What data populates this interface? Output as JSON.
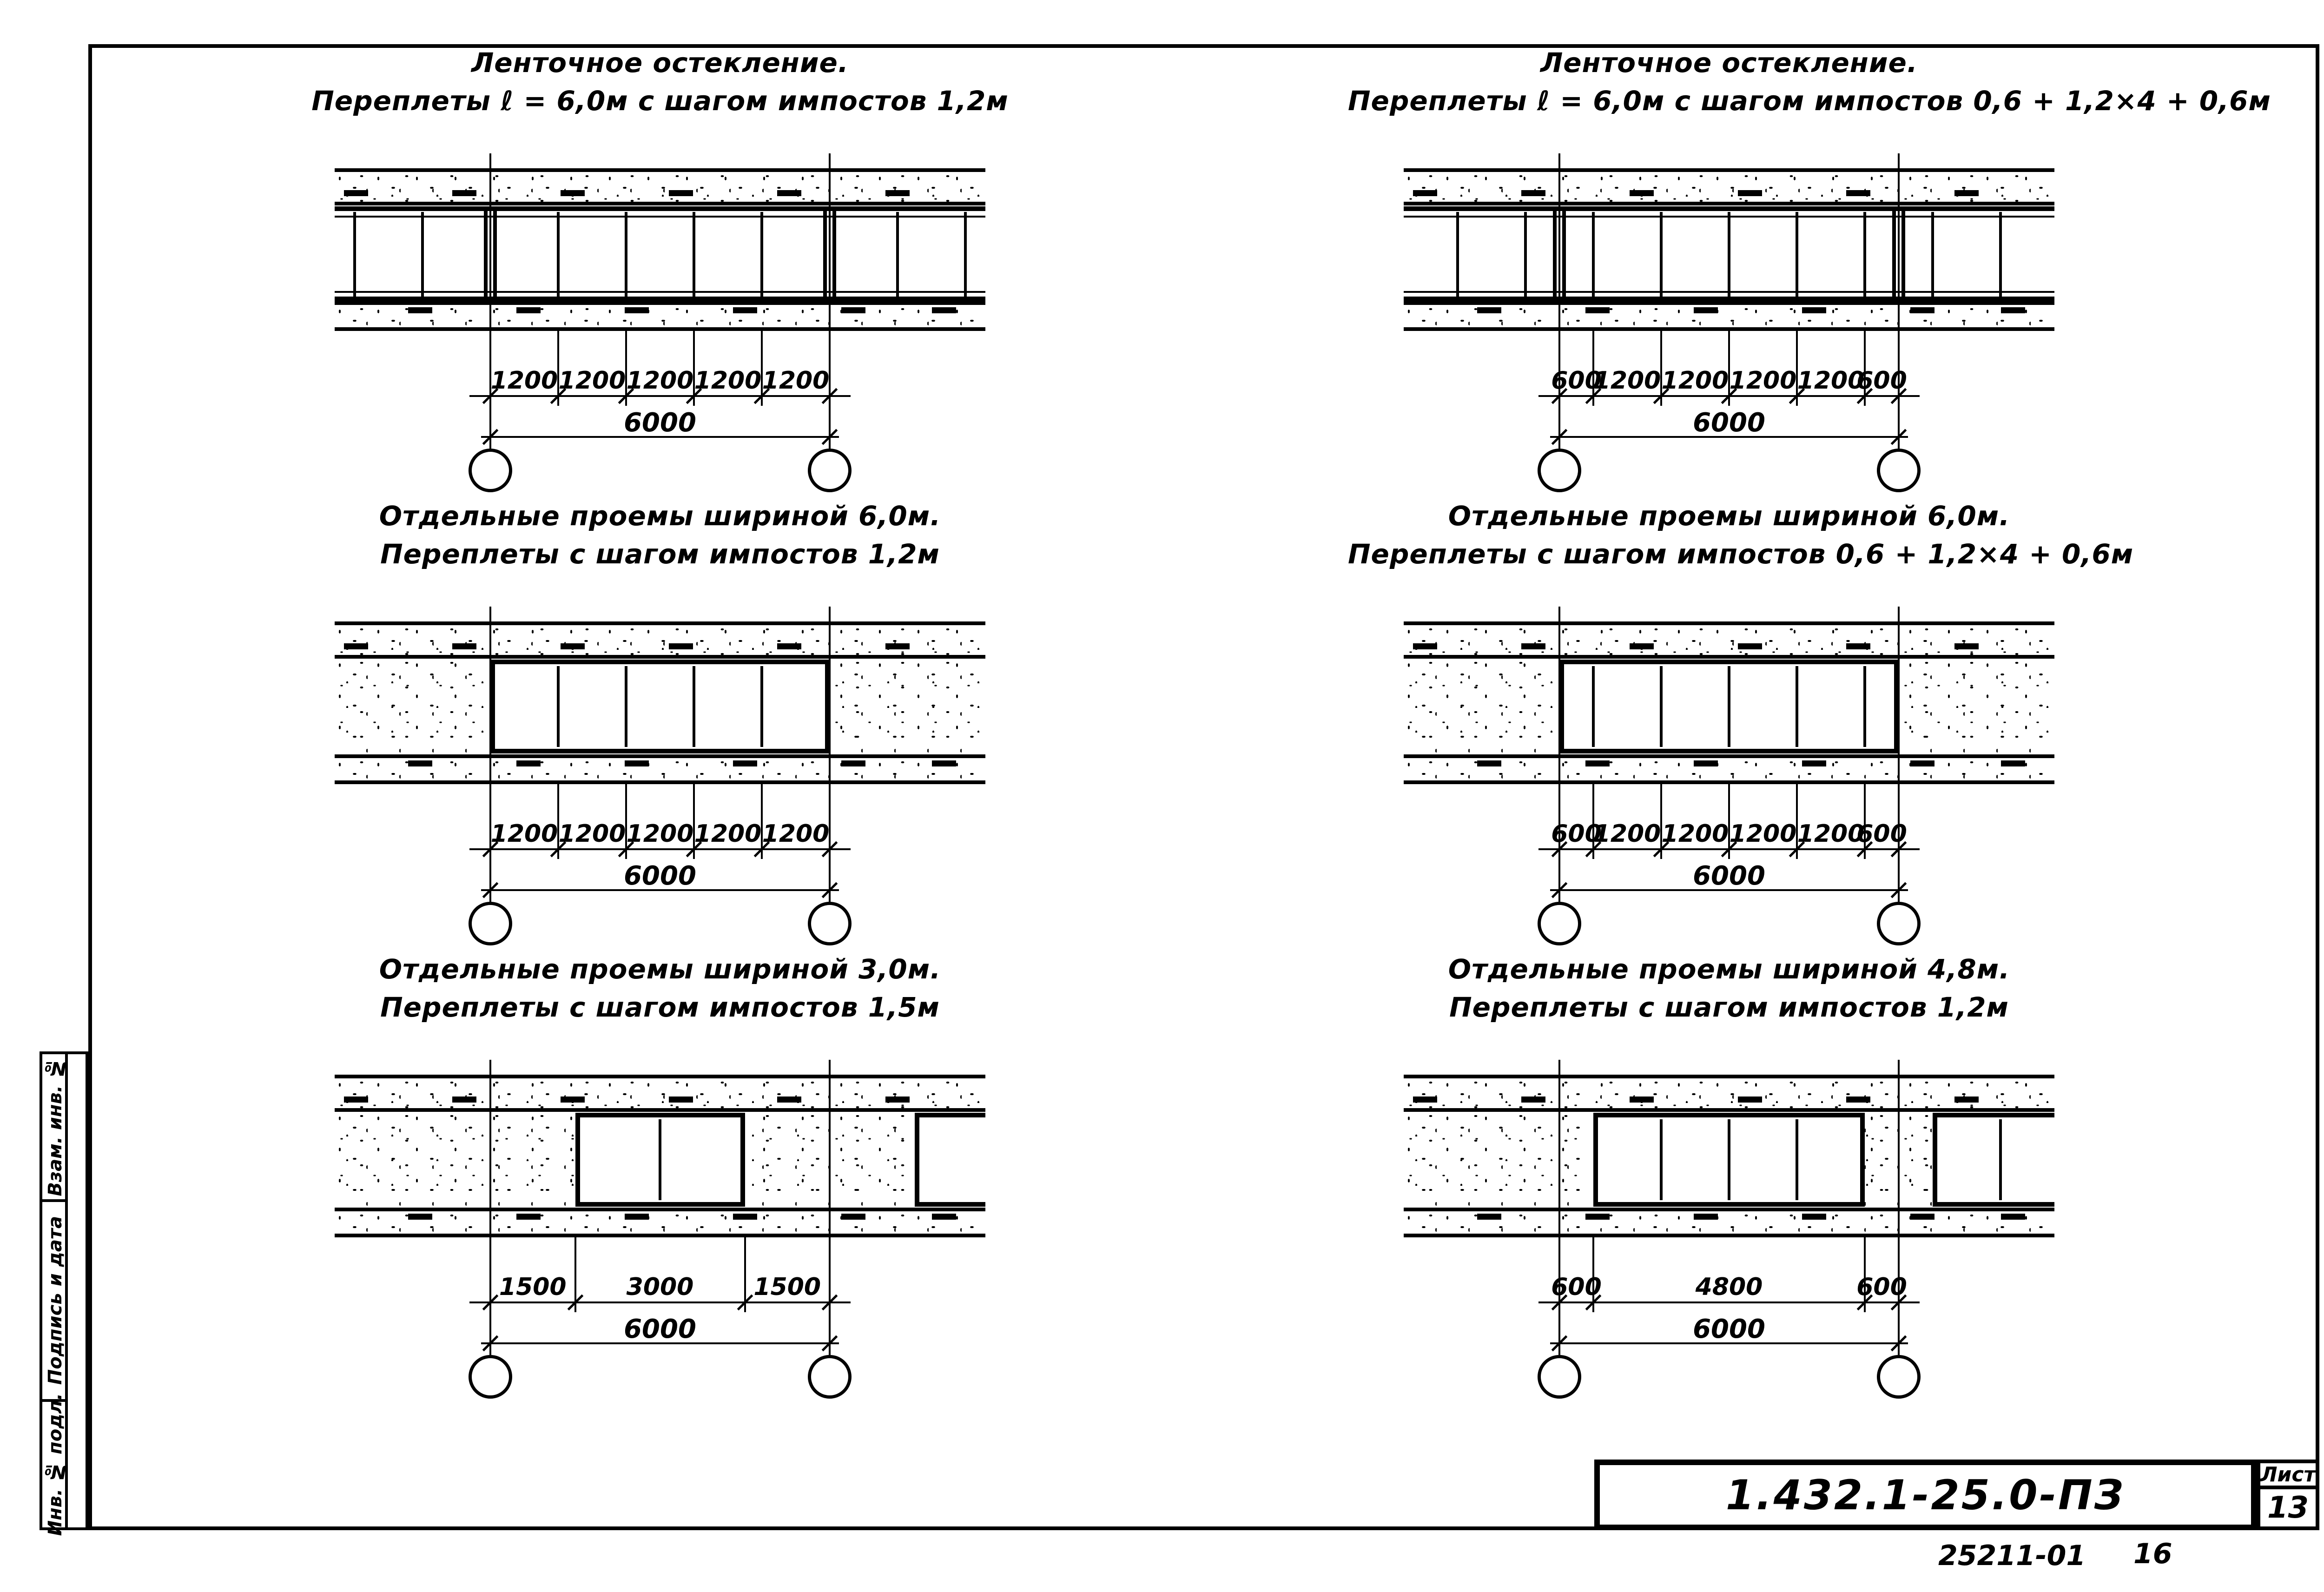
{
  "sheet": {
    "title_block": {
      "code": "1.432.1-25.0-ПЗ",
      "sheet_label": "Лист",
      "sheet_number": "13"
    },
    "margin_notes": [
      "25211-01",
      "16"
    ],
    "side_stamp_labels": [
      "Взам. инв. №",
      "Подпись и дата",
      "Инв. № подл."
    ]
  },
  "panels": [
    {
      "id": "ribbon-1200",
      "title1": "Ленточное остекление.",
      "title2": "Переплеты ℓ = 6,0м с шагом импостов 1,2м",
      "type": "ribbon",
      "segments": [
        1200,
        1200,
        1200,
        1200,
        1200
      ],
      "segment_labels": [
        "1200",
        "1200",
        "1200",
        "1200",
        "1200"
      ],
      "total_label": "6000",
      "side_mullions": [
        1200,
        2400
      ]
    },
    {
      "id": "ribbon-600-1200",
      "title1": "Ленточное остекление.",
      "title2": "Переплеты ℓ = 6,0м с шагом импостов 0,6 + 1,2×4 + 0,6м",
      "type": "ribbon",
      "segments": [
        600,
        1200,
        1200,
        1200,
        1200,
        600
      ],
      "segment_labels": [
        "600",
        "1200",
        "1200",
        "1200",
        "1200",
        "600"
      ],
      "total_label": "6000",
      "side_mullions": [
        600,
        1800
      ]
    },
    {
      "id": "opening-6000-1200",
      "title1": "Отдельные проемы шириной 6,0м.",
      "title2": "Переплеты с шагом импостов 1,2м",
      "type": "opening",
      "segments": [
        1200,
        1200,
        1200,
        1200,
        1200
      ],
      "segment_labels": [
        "1200",
        "1200",
        "1200",
        "1200",
        "1200"
      ],
      "total_label": "6000",
      "opening": [
        0,
        6000
      ],
      "opening_mullions": [
        1200,
        2400,
        3600,
        4800
      ]
    },
    {
      "id": "opening-6000-600-1200",
      "title1": "Отдельные проемы шириной 6,0м.",
      "title2": "Переплеты с шагом импостов 0,6 + 1,2×4 + 0,6м",
      "type": "opening",
      "segments": [
        600,
        1200,
        1200,
        1200,
        1200,
        600
      ],
      "segment_labels": [
        "600",
        "1200",
        "1200",
        "1200",
        "1200",
        "600"
      ],
      "total_label": "6000",
      "opening": [
        0,
        6000
      ],
      "opening_mullions": [
        600,
        1800,
        3000,
        4200,
        5400
      ]
    },
    {
      "id": "opening-3000-1500",
      "title1": "Отдельные проемы шириной 3,0м.",
      "title2": "Переплеты с шагом импостов 1,5м",
      "type": "opening",
      "segments": [
        1500,
        3000,
        1500
      ],
      "segment_labels": [
        "1500",
        "3000",
        "1500"
      ],
      "total_label": "6000",
      "opening": [
        1500,
        4500
      ],
      "opening_mullions": [
        1500
      ],
      "right_partial": {
        "start": 1500,
        "mullions": []
      }
    },
    {
      "id": "opening-4800-1200",
      "title1": "Отдельные проемы шириной 4,8м.",
      "title2": "Переплеты с шагом импостов 1,2м",
      "type": "opening",
      "segments": [
        600,
        4800,
        600
      ],
      "segment_labels": [
        "600",
        "4800",
        "600"
      ],
      "total_label": "6000",
      "opening": [
        600,
        5400
      ],
      "opening_mullions": [
        1200,
        2400,
        3600
      ],
      "right_partial": {
        "start": 600,
        "mullions": [
          1200
        ]
      }
    }
  ]
}
